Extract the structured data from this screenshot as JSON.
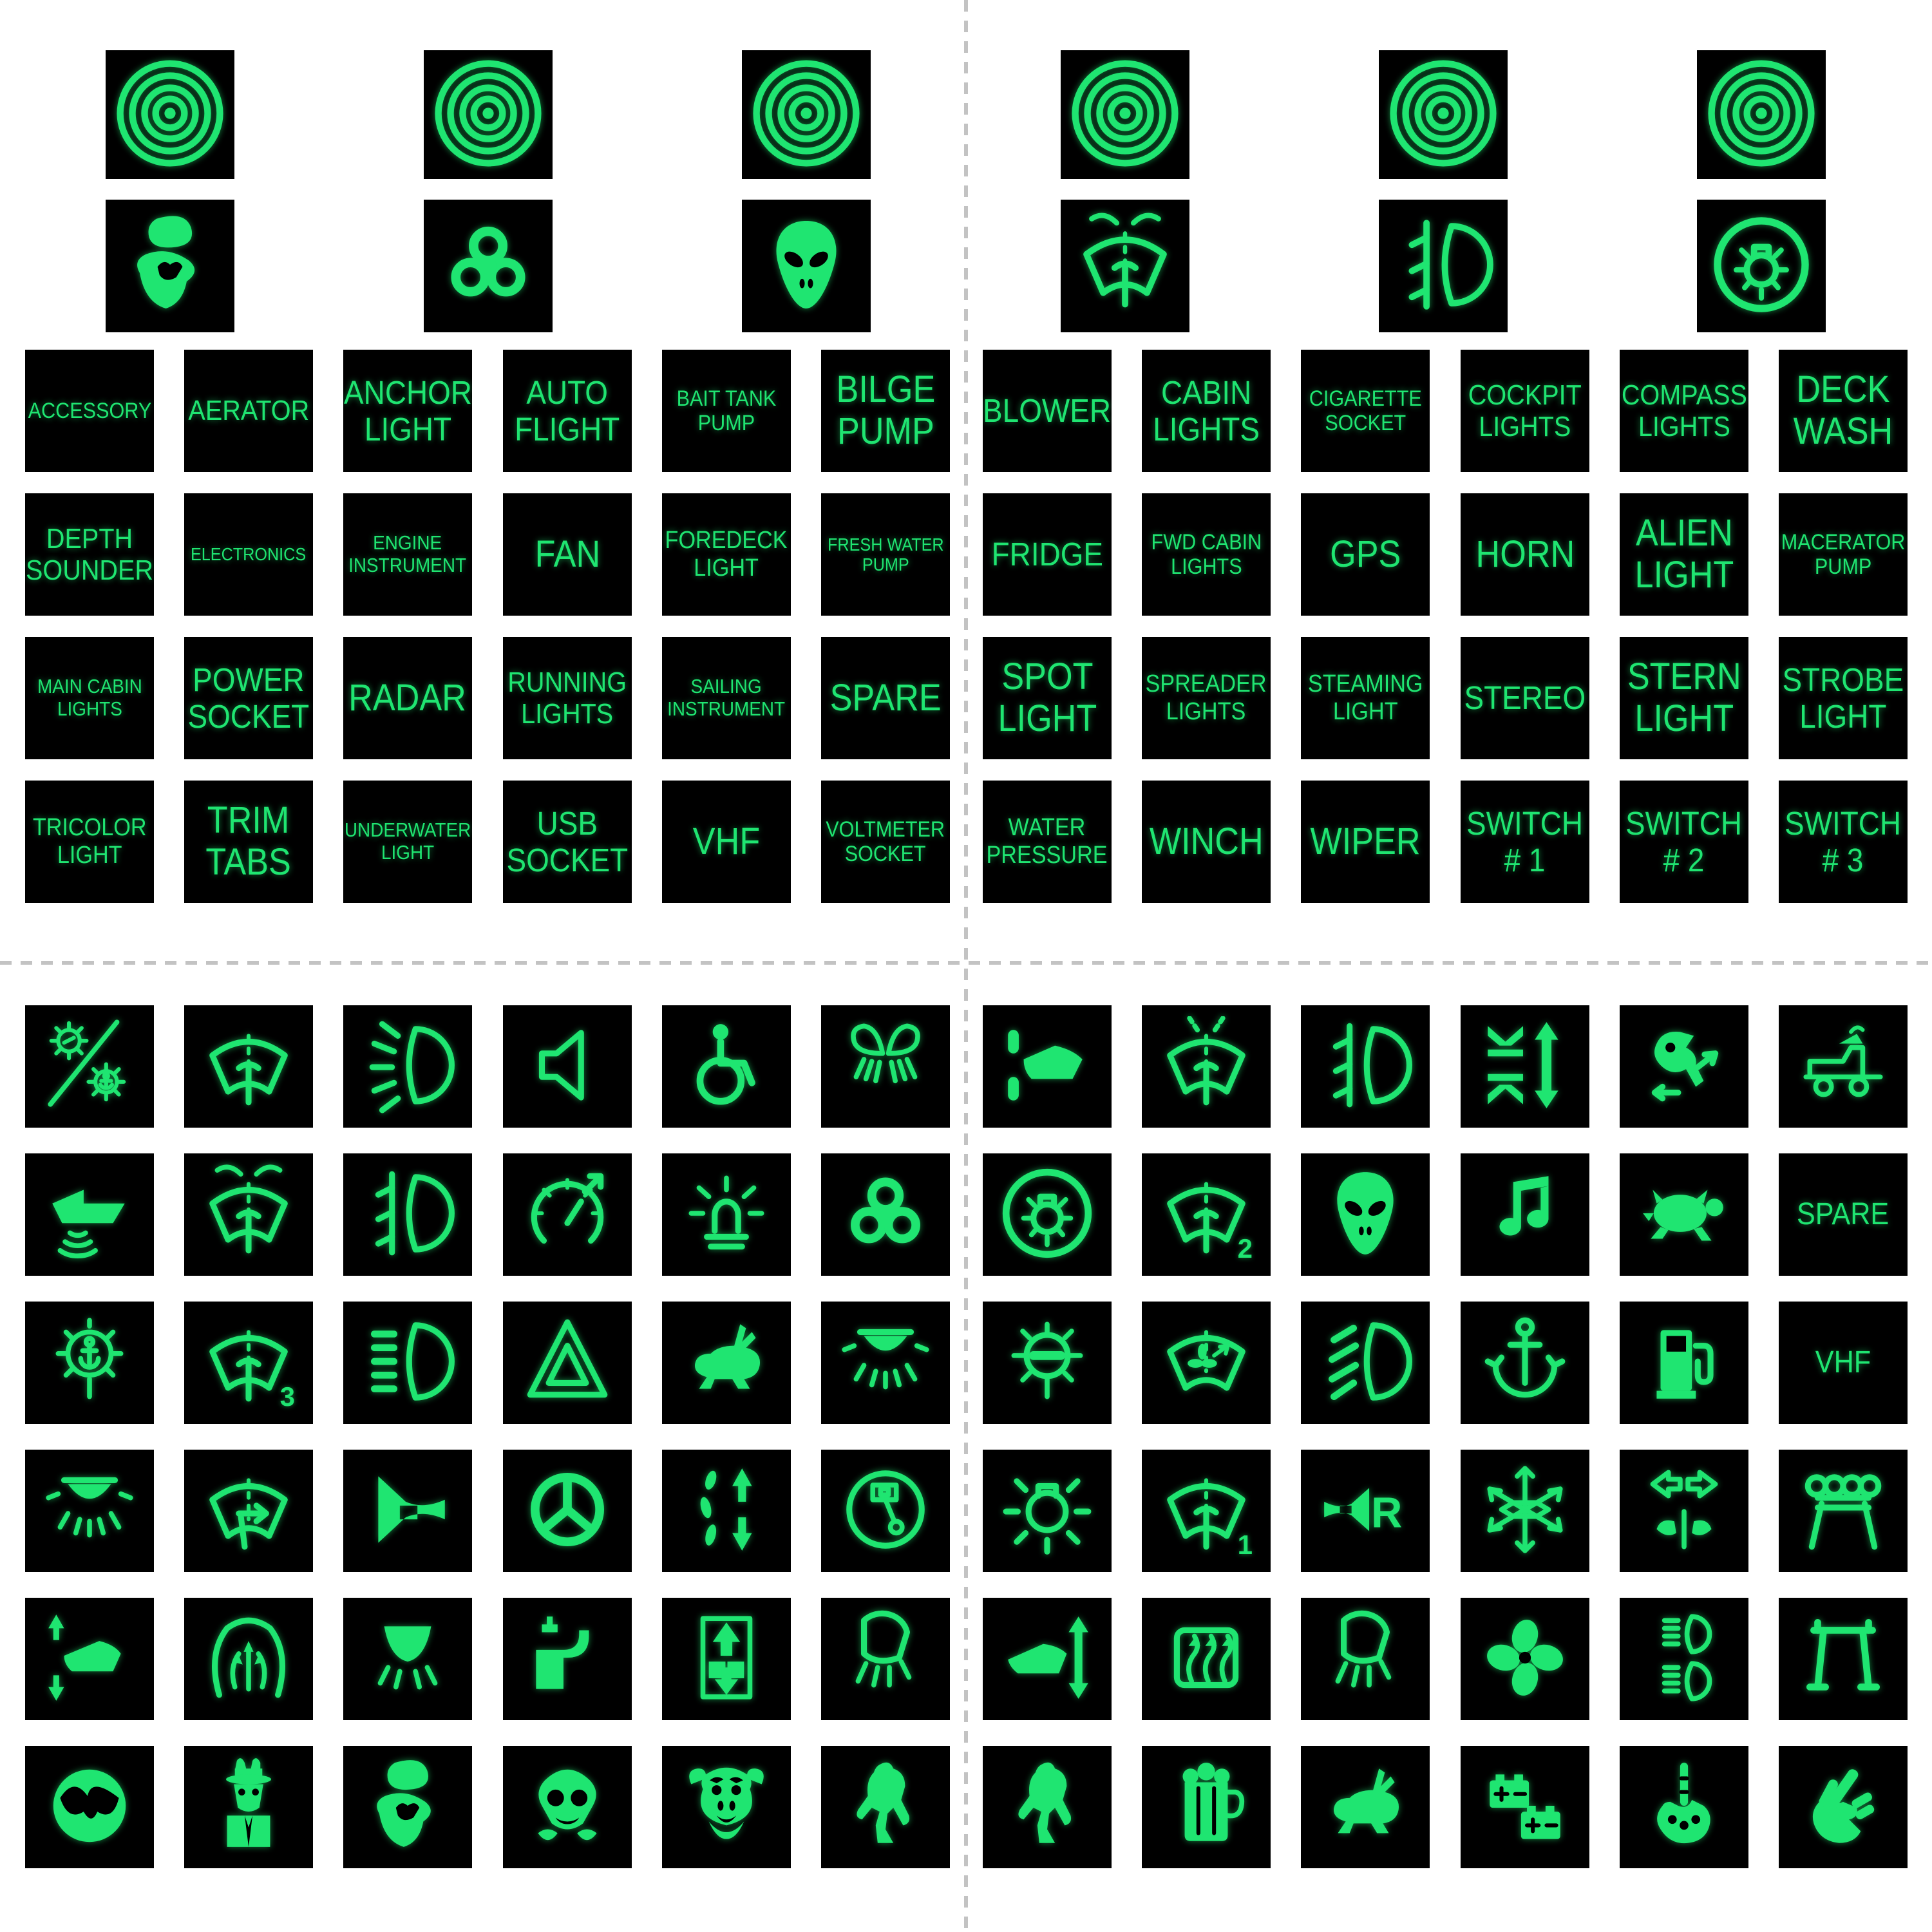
{
  "colors": {
    "background": "#ffffff",
    "tile_background": "#000000",
    "glow_green": "#1fe571",
    "cut_line_gray": "#c3c3c3"
  },
  "sheet": {
    "top_left": {
      "targets": [
        {
          "name": "registration-target-icon",
          "icon": "spiral"
        },
        {
          "name": "registration-target-icon",
          "icon": "spiral"
        },
        {
          "name": "registration-target-icon",
          "icon": "spiral"
        }
      ],
      "icons": [
        {
          "name": "grumpy-face-icon",
          "icon": "grumpy"
        },
        {
          "name": "biohazard-icon",
          "icon": "biohazard"
        },
        {
          "name": "alien-icon",
          "icon": "alien"
        }
      ],
      "labels": [
        [
          [
            "ACCESSORY"
          ],
          [
            "AERATOR"
          ],
          [
            "ANCHOR",
            "LIGHT"
          ],
          [
            "AUTO",
            "FLIGHT"
          ],
          [
            "BAIT TANK",
            "PUMP"
          ],
          [
            "BILGE",
            "PUMP"
          ]
        ],
        [
          [
            "DEPTH",
            "SOUNDER"
          ],
          [
            "ELECTRONICS"
          ],
          [
            "ENGINE",
            "INSTRUMENT"
          ],
          [
            "FAN"
          ],
          [
            "FOREDECK",
            "LIGHT"
          ],
          [
            "FRESH WATER",
            "PUMP"
          ]
        ],
        [
          [
            "MAIN CABIN",
            "LIGHTS"
          ],
          [
            "POWER",
            "SOCKET"
          ],
          [
            "RADAR"
          ],
          [
            "RUNNING",
            "LIGHTS"
          ],
          [
            "SAILING",
            "INSTRUMENT"
          ],
          [
            "SPARE"
          ]
        ],
        [
          [
            "TRICOLOR",
            "LIGHT"
          ],
          [
            "TRIM",
            "TABS"
          ],
          [
            "UNDERWATER",
            "LIGHT"
          ],
          [
            "USB",
            "SOCKET"
          ],
          [
            "VHF"
          ],
          [
            "VOLTMETER",
            "SOCKET"
          ]
        ]
      ]
    },
    "top_right": {
      "targets": [
        {
          "name": "registration-target-icon",
          "icon": "spiral"
        },
        {
          "name": "registration-target-icon",
          "icon": "spiral"
        },
        {
          "name": "registration-target-icon",
          "icon": "spiral"
        }
      ],
      "icons": [
        {
          "name": "windshield-washer-icon",
          "icon": "wiper_washer"
        },
        {
          "name": "fog-light-icon",
          "icon": "lamp_plugs"
        },
        {
          "name": "navigation-light-icon",
          "icon": "navlight"
        }
      ],
      "labels": [
        [
          [
            "BLOWER"
          ],
          [
            "CABIN",
            "LIGHTS"
          ],
          [
            "CIGARETTE",
            "SOCKET"
          ],
          [
            "COCKPIT",
            "LIGHTS"
          ],
          [
            "COMPASS",
            "LIGHTS"
          ],
          [
            "DECK",
            "WASH"
          ]
        ],
        [
          [
            "FRIDGE"
          ],
          [
            "FWD CABIN",
            "LIGHTS"
          ],
          [
            "GPS"
          ],
          [
            "HORN"
          ],
          [
            "ALIEN",
            "LIGHT"
          ],
          [
            "MACERATOR",
            "PUMP"
          ]
        ],
        [
          [
            "SPOT",
            "LIGHT"
          ],
          [
            "SPREADER",
            "LIGHTS"
          ],
          [
            "STEAMING",
            "LIGHT"
          ],
          [
            "STEREO"
          ],
          [
            "STERN",
            "LIGHT"
          ],
          [
            "STROBE",
            "LIGHT"
          ]
        ],
        [
          [
            "WATER",
            "PRESSURE"
          ],
          [
            "WINCH"
          ],
          [
            "WIPER"
          ],
          [
            "SWITCH",
            "# 1"
          ],
          [
            "SWITCH",
            "# 2"
          ],
          [
            "SWITCH",
            "# 3"
          ]
        ]
      ]
    },
    "bottom_left": {
      "icon_grid": [
        [
          {
            "name": "light-off-slash-icon",
            "icon": "light_slash"
          },
          {
            "name": "wiper-icon",
            "icon": "wiper"
          },
          {
            "name": "headlight-rays-icon",
            "icon": "lamp_rays"
          },
          {
            "name": "speaker-icon",
            "icon": "speaker"
          },
          {
            "name": "wheelchair-icon",
            "icon": "wheelchair"
          },
          {
            "name": "mittens-icon",
            "icon": "mittens"
          }
        ],
        [
          {
            "name": "depth-sounder-icon",
            "icon": "boat_sonar"
          },
          {
            "name": "windshield-washer-icon",
            "icon": "wiper_washer"
          },
          {
            "name": "fog-light-icon",
            "icon": "lamp_plugs"
          },
          {
            "name": "speedometer-icon",
            "icon": "speedo"
          },
          {
            "name": "beacon-light-icon",
            "icon": "beacon"
          },
          {
            "name": "biohazard-icon",
            "icon": "biohazard"
          }
        ],
        [
          {
            "name": "anchor-light-icon",
            "icon": "anchor_light"
          },
          {
            "name": "wiper-speed-3-icon",
            "icon": "wiper",
            "num": "3"
          },
          {
            "name": "headlight-dashes-icon",
            "icon": "lamp_dashes"
          },
          {
            "name": "hazard-triangle-icon",
            "icon": "triangle"
          },
          {
            "name": "rabbit-icon",
            "icon": "rabbit"
          },
          {
            "name": "dome-light-icon",
            "icon": "dome_light"
          }
        ],
        [
          {
            "name": "dome-light-icon",
            "icon": "dome_light"
          },
          {
            "name": "wiper-arrow-icon",
            "icon": "wiper_arrow"
          },
          {
            "name": "horn-icon",
            "icon": "horn"
          },
          {
            "name": "helm-wheel-icon",
            "icon": "wheel"
          },
          {
            "name": "bait-lift-icon",
            "icon": "bait_arrows"
          },
          {
            "name": "engine-piston-icon",
            "icon": "piston"
          }
        ],
        [
          {
            "name": "boat-trim-icon",
            "icon": "boat_arrows"
          },
          {
            "name": "windshield-defrost-icon",
            "icon": "defrost_front"
          },
          {
            "name": "spreader-light-icon",
            "icon": "spreader"
          },
          {
            "name": "water-tap-icon",
            "icon": "faucet"
          },
          {
            "name": "hoist-icon",
            "icon": "lift_box"
          },
          {
            "name": "deck-light-icon",
            "icon": "foredeck"
          }
        ],
        [
          {
            "name": "owl-icon",
            "icon": "owl"
          },
          {
            "name": "detective-icon",
            "icon": "detective"
          },
          {
            "name": "grumpy-face-icon",
            "icon": "grumpy"
          },
          {
            "name": "gas-mask-icon",
            "icon": "gasmask"
          },
          {
            "name": "monkey-icon",
            "icon": "monkey"
          },
          {
            "name": "swamp-creature-icon",
            "icon": "bigfoot"
          }
        ]
      ]
    },
    "bottom_right": {
      "icon_grid": [
        [
          {
            "name": "boat-lift-icon",
            "icon": "boat_lift"
          },
          {
            "name": "washer-spray-icon",
            "icon": "wiper_washer2"
          },
          {
            "name": "fog-light-icon",
            "icon": "lamp_plugs"
          },
          {
            "name": "windlass-icon",
            "icon": "compress_arrows"
          },
          {
            "name": "outboard-tilt-icon",
            "icon": "outboard"
          },
          {
            "name": "boat-trailer-icon",
            "icon": "trailer"
          }
        ],
        [
          {
            "name": "navigation-light-icon",
            "icon": "navlight"
          },
          {
            "name": "wiper-speed-2-icon",
            "icon": "wiper",
            "num": "2"
          },
          {
            "name": "alien-icon",
            "icon": "alien"
          },
          {
            "name": "music-note-icon",
            "icon": "note"
          },
          {
            "name": "turtle-icon",
            "icon": "turtle"
          },
          {
            "name": "spare-label",
            "label": [
              "SPARE"
            ]
          }
        ],
        [
          {
            "name": "masthead-light-icon",
            "icon": "masthead"
          },
          {
            "name": "wiper-vent-icon",
            "icon": "wiper_fan"
          },
          {
            "name": "headlight-beam-icon",
            "icon": "lamp_slashes"
          },
          {
            "name": "anchor-icon",
            "icon": "anchor"
          },
          {
            "name": "fuel-pump-icon",
            "icon": "fuel"
          },
          {
            "name": "vhf-label",
            "label": [
              "VHF"
            ]
          }
        ],
        [
          {
            "name": "cabin-light-icon",
            "icon": "bulb_rays"
          },
          {
            "name": "wiper-speed-1-icon",
            "icon": "wiper",
            "num": "1"
          },
          {
            "name": "reverse-horn-icon",
            "icon": "horn_r"
          },
          {
            "name": "snowflake-icon",
            "icon": "snowflake"
          },
          {
            "name": "nav-side-lights-icon",
            "icon": "nav_arrows"
          },
          {
            "name": "rod-holder-icon",
            "icon": "rod_rack"
          }
        ],
        [
          {
            "name": "trim-tab-icon",
            "icon": "trim_single"
          },
          {
            "name": "rear-defrost-icon",
            "icon": "defrost_rear"
          },
          {
            "name": "foredeck-light-icon",
            "icon": "foredeck"
          },
          {
            "name": "propeller-icon",
            "icon": "propeller"
          },
          {
            "name": "dual-beam-icon",
            "icon": "dual_lamps"
          },
          {
            "name": "swim-platform-icon",
            "icon": "platform"
          }
        ],
        [
          {
            "name": "bigfoot-icon",
            "icon": "bigfoot"
          },
          {
            "name": "beer-mugs-icon",
            "icon": "beer"
          },
          {
            "name": "running-rabbit-icon",
            "icon": "rabbit"
          },
          {
            "name": "battery-icon",
            "icon": "batteries"
          },
          {
            "name": "skeleton-finger-icon",
            "icon": "skel_finger"
          },
          {
            "name": "peace-hand-icon",
            "icon": "peace_hand"
          }
        ]
      ]
    }
  }
}
